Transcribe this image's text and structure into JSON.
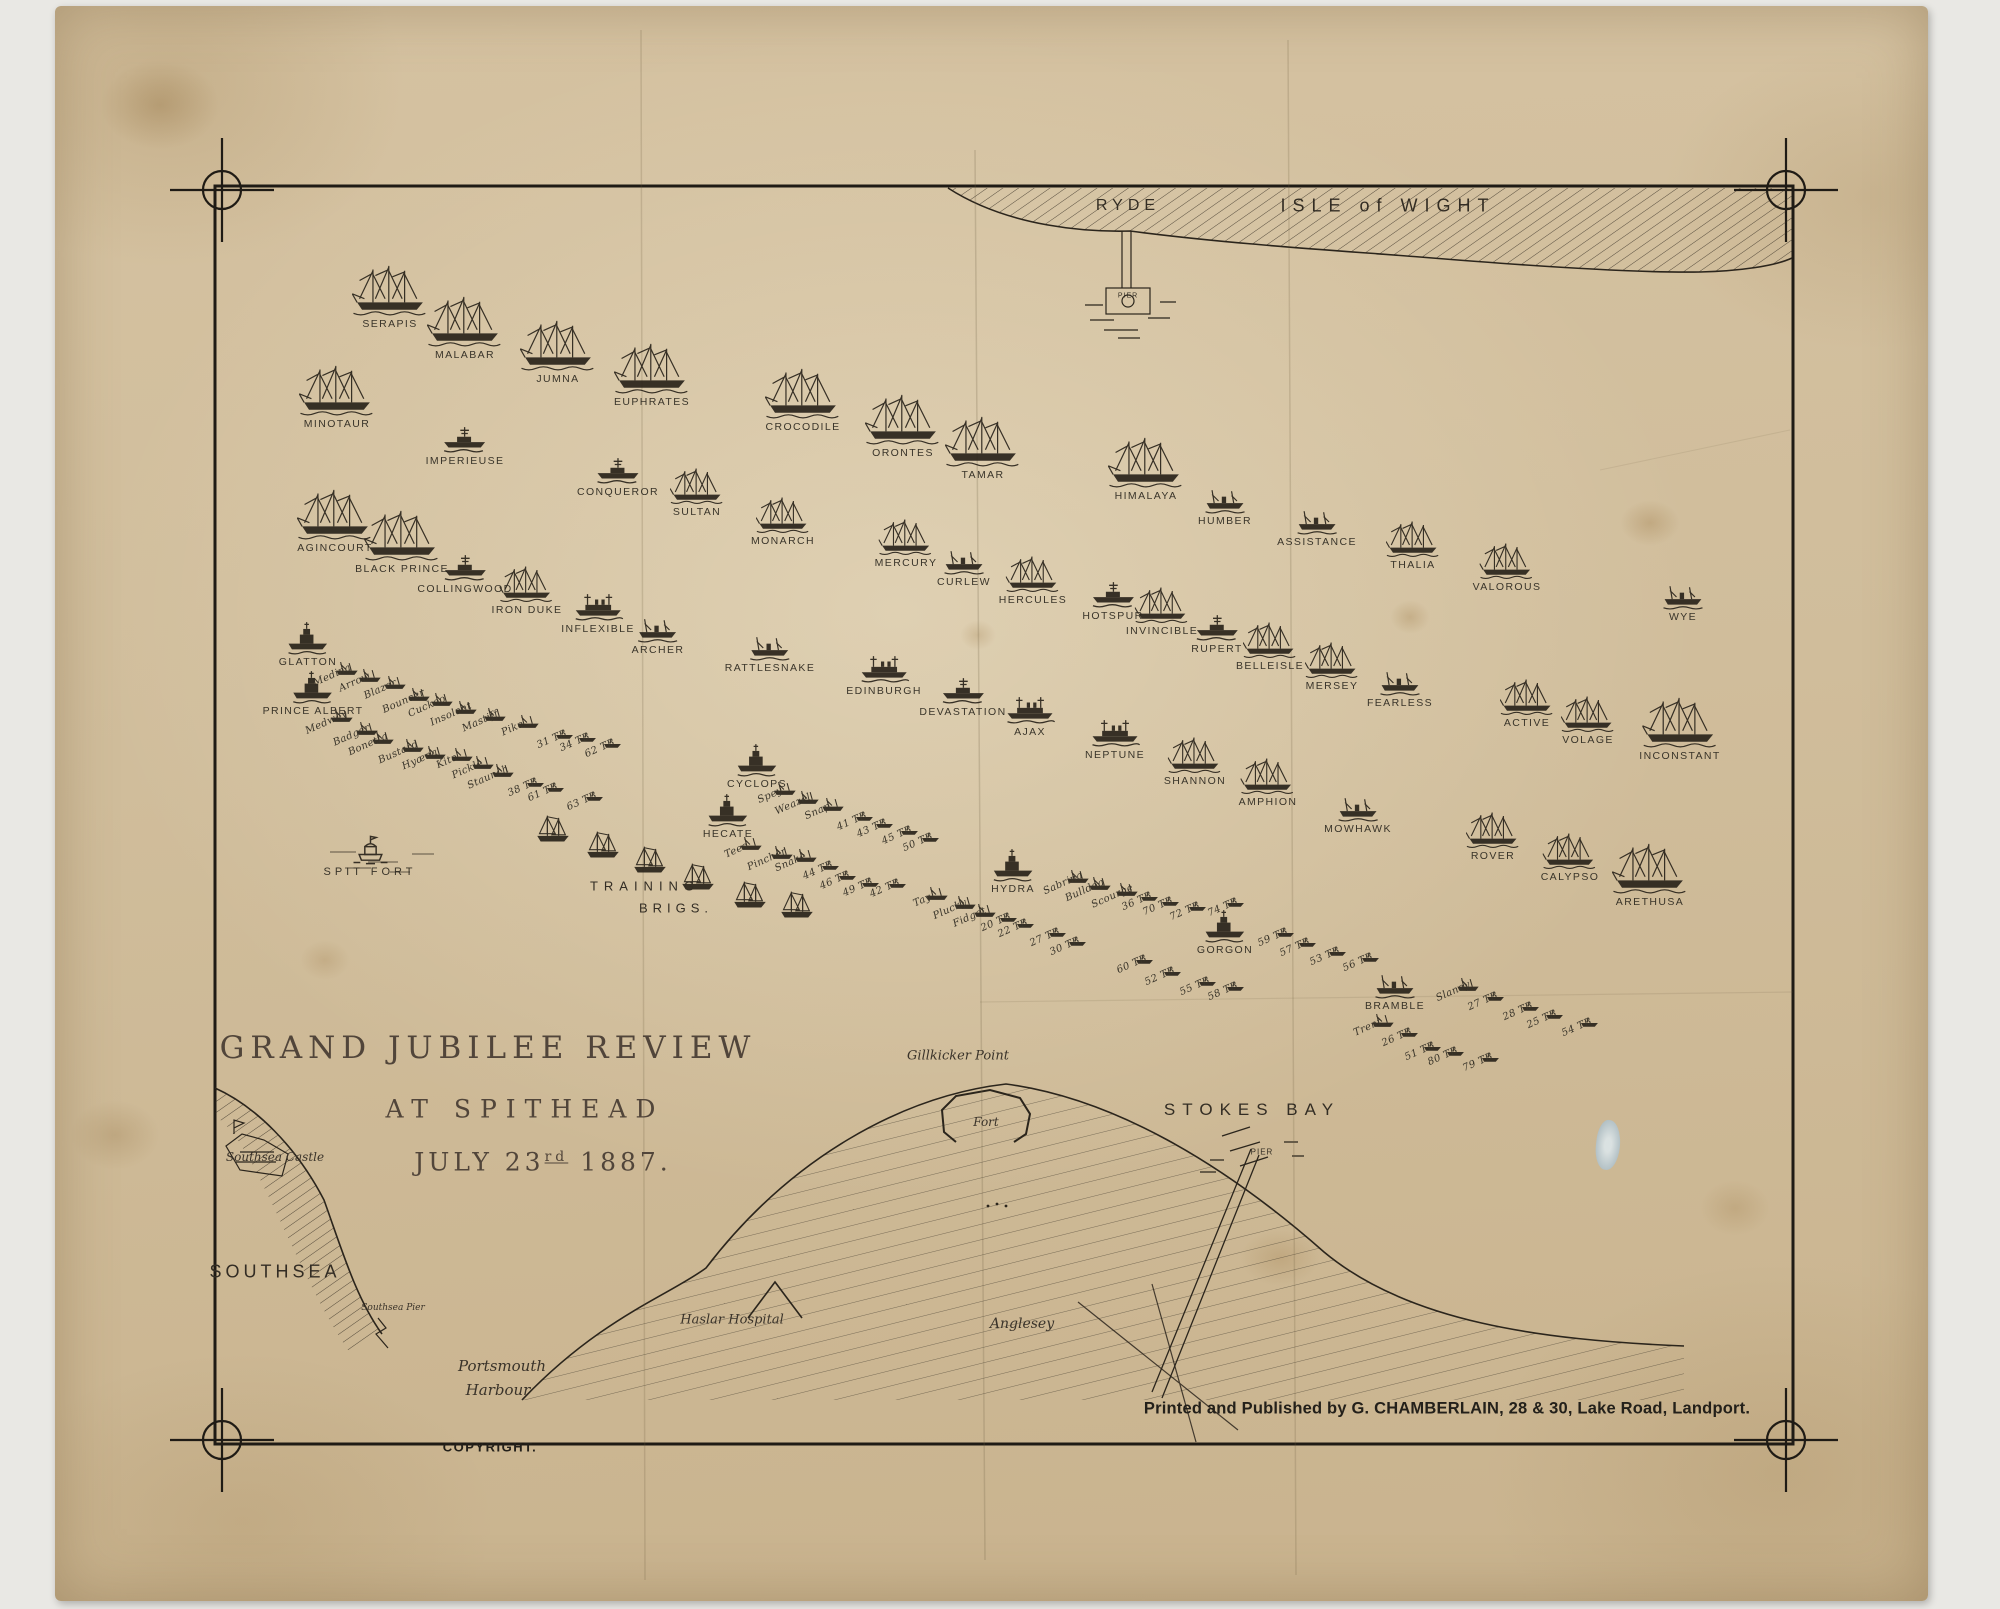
{
  "title": {
    "line1": "GRAND JUBILEE REVIEW",
    "line2": "AT SPITHEAD",
    "date_pre": "JULY 23",
    "date_sup": "rd",
    "date_post": " 1887."
  },
  "imprint": {
    "publisher": "Printed and Published by G. CHAMBERLAIN, 28 & 30, Lake Road, Landport.",
    "copyright": "COPYRIGHT."
  },
  "geography": {
    "isle_of_wight": "ISLE of WIGHT",
    "ryde": "RYDE",
    "ryde_pier": "PIER",
    "training_1": "TRAINING",
    "training_2": "BRIGS.",
    "southsea_castle": "Southsea Castle",
    "southsea": "SOUTHSEA",
    "southsea_pier": "Southsea Pier",
    "portsmouth_1": "Portsmouth",
    "portsmouth_2": "Harbour",
    "gillkicker": "Gillkicker Point",
    "fort": "Fort",
    "haslar": "Haslar Hospital",
    "anglesey": "Anglesey",
    "stokes_bay": "STOKES BAY",
    "stokes_pier": "PIER"
  },
  "colors": {
    "paper": "#d2bf9e",
    "ink": "#2b251c",
    "scan_bed": "#e9e8e4"
  },
  "ships": [
    {
      "n": "SERAPIS",
      "x": 390,
      "y": 330,
      "t": "sailL"
    },
    {
      "n": "MALABAR",
      "x": 465,
      "y": 361,
      "t": "sailL"
    },
    {
      "n": "JUMNA",
      "x": 558,
      "y": 385,
      "t": "sailL"
    },
    {
      "n": "EUPHRATES",
      "x": 652,
      "y": 408,
      "t": "sailL"
    },
    {
      "n": "CROCODILE",
      "x": 803,
      "y": 433,
      "t": "sailL"
    },
    {
      "n": "ORONTES",
      "x": 903,
      "y": 459,
      "t": "sailL"
    },
    {
      "n": "TAMAR",
      "x": 983,
      "y": 481,
      "t": "sailL"
    },
    {
      "n": "HIMALAYA",
      "x": 1146,
      "y": 502,
      "t": "sailL"
    },
    {
      "n": "HUMBER",
      "x": 1225,
      "y": 527,
      "t": "steamer"
    },
    {
      "n": "ASSISTANCE",
      "x": 1317,
      "y": 548,
      "t": "steamer"
    },
    {
      "n": "THALIA",
      "x": 1413,
      "y": 571,
      "t": "sailM"
    },
    {
      "n": "VALOROUS",
      "x": 1507,
      "y": 593,
      "t": "sailM"
    },
    {
      "n": "WYE",
      "x": 1683,
      "y": 623,
      "t": "steamer"
    },
    {
      "n": "MINOTAUR",
      "x": 337,
      "y": 430,
      "t": "sailL"
    },
    {
      "n": "IMPERIEUSE",
      "x": 465,
      "y": 467,
      "t": "bb"
    },
    {
      "n": "CONQUEROR",
      "x": 618,
      "y": 498,
      "t": "bb"
    },
    {
      "n": "SULTAN",
      "x": 697,
      "y": 518,
      "t": "sailM"
    },
    {
      "n": "MONARCH",
      "x": 783,
      "y": 547,
      "t": "sailM"
    },
    {
      "n": "MERCURY",
      "x": 906,
      "y": 569,
      "t": "sailM"
    },
    {
      "n": "CURLEW",
      "x": 964,
      "y": 588,
      "t": "steamer"
    },
    {
      "n": "HERCULES",
      "x": 1033,
      "y": 606,
      "t": "sailM"
    },
    {
      "n": "HOTSPUR",
      "x": 1113,
      "y": 622,
      "t": "bb"
    },
    {
      "n": "INVINCIBLE",
      "x": 1162,
      "y": 637,
      "t": "sailM"
    },
    {
      "n": "RUPERT",
      "x": 1217,
      "y": 655,
      "t": "bb"
    },
    {
      "n": "BELLEISLE",
      "x": 1270,
      "y": 672,
      "t": "sailM"
    },
    {
      "n": "MERSEY",
      "x": 1332,
      "y": 692,
      "t": "sailM"
    },
    {
      "n": "FEARLESS",
      "x": 1400,
      "y": 709,
      "t": "steamer"
    },
    {
      "n": "ACTIVE",
      "x": 1527,
      "y": 729,
      "t": "sailM"
    },
    {
      "n": "VOLAGE",
      "x": 1588,
      "y": 746,
      "t": "sailM"
    },
    {
      "n": "INCONSTANT",
      "x": 1680,
      "y": 762,
      "t": "sailL"
    },
    {
      "n": "AGINCOURT",
      "x": 335,
      "y": 554,
      "t": "sailL"
    },
    {
      "n": "BLACK PRINCE",
      "x": 402,
      "y": 575,
      "t": "sailL"
    },
    {
      "n": "COLLINGWOOD",
      "x": 465,
      "y": 595,
      "t": "bb"
    },
    {
      "n": "IRON DUKE",
      "x": 527,
      "y": 616,
      "t": "sailM"
    },
    {
      "n": "INFLEXIBLE",
      "x": 598,
      "y": 635,
      "t": "bb2"
    },
    {
      "n": "ARCHER",
      "x": 658,
      "y": 656,
      "t": "steamer"
    },
    {
      "n": "RATTLESNAKE",
      "x": 770,
      "y": 674,
      "t": "steamer"
    },
    {
      "n": "EDINBURGH",
      "x": 884,
      "y": 697,
      "t": "bb2"
    },
    {
      "n": "DEVASTATION",
      "x": 963,
      "y": 718,
      "t": "bb"
    },
    {
      "n": "AJAX",
      "x": 1030,
      "y": 738,
      "t": "bb2"
    },
    {
      "n": "NEPTUNE",
      "x": 1115,
      "y": 761,
      "t": "bb2"
    },
    {
      "n": "SHANNON",
      "x": 1195,
      "y": 787,
      "t": "sailM"
    },
    {
      "n": "AMPHION",
      "x": 1268,
      "y": 808,
      "t": "sailM"
    },
    {
      "n": "MOWHAWK",
      "x": 1358,
      "y": 835,
      "t": "steamer"
    },
    {
      "n": "ROVER",
      "x": 1493,
      "y": 862,
      "t": "sailM"
    },
    {
      "n": "CALYPSO",
      "x": 1570,
      "y": 883,
      "t": "sailM"
    },
    {
      "n": "ARETHUSA",
      "x": 1650,
      "y": 908,
      "t": "sailL"
    },
    {
      "n": "GLATTON",
      "x": 308,
      "y": 668,
      "t": "mon"
    },
    {
      "n": "PRINCE ALBERT",
      "x": 313,
      "y": 717,
      "t": "mon"
    },
    {
      "n": "CYCLOPS",
      "x": 757,
      "y": 790,
      "t": "mon"
    },
    {
      "n": "HECATE",
      "x": 728,
      "y": 840,
      "t": "mon"
    },
    {
      "n": "HYDRA",
      "x": 1013,
      "y": 895,
      "t": "mon"
    },
    {
      "n": "GORGON",
      "x": 1225,
      "y": 956,
      "t": "mon"
    },
    {
      "n": "BRAMBLE",
      "x": 1395,
      "y": 1012,
      "t": "steamer"
    },
    {
      "n": "SPIT FORT",
      "x": 370,
      "y": 878,
      "t": "fort",
      "s": "wide"
    },
    {
      "n": "Medina",
      "x": 332,
      "y": 681,
      "t": "gb",
      "s": "script"
    },
    {
      "n": "Arrow",
      "x": 355,
      "y": 688,
      "t": "gb",
      "s": "script"
    },
    {
      "n": "Blazer",
      "x": 380,
      "y": 695,
      "t": "gb",
      "s": "script"
    },
    {
      "n": "Bouncer",
      "x": 404,
      "y": 707,
      "t": "gb",
      "s": "script"
    },
    {
      "n": "Cuckoo",
      "x": 427,
      "y": 712,
      "t": "gb",
      "s": "script"
    },
    {
      "n": "Insolent",
      "x": 451,
      "y": 720,
      "t": "gb",
      "s": "script"
    },
    {
      "n": "Mastiff",
      "x": 480,
      "y": 727,
      "t": "gb",
      "s": "script"
    },
    {
      "n": "Pike",
      "x": 513,
      "y": 734,
      "t": "gb",
      "s": "script"
    },
    {
      "n": "Medway",
      "x": 327,
      "y": 728,
      "t": "gb",
      "s": "script"
    },
    {
      "n": "Badger",
      "x": 352,
      "y": 741,
      "t": "gb",
      "s": "script"
    },
    {
      "n": "Bonetta",
      "x": 368,
      "y": 750,
      "t": "gb",
      "s": "script"
    },
    {
      "n": "Bustard",
      "x": 398,
      "y": 758,
      "t": "gb",
      "s": "script"
    },
    {
      "n": "Hyæna",
      "x": 420,
      "y": 765,
      "t": "gb",
      "s": "script"
    },
    {
      "n": "Kite",
      "x": 447,
      "y": 767,
      "t": "gb",
      "s": "script"
    },
    {
      "n": "Pickle",
      "x": 468,
      "y": 775,
      "t": "gb",
      "s": "script"
    },
    {
      "n": "Staunch",
      "x": 488,
      "y": 783,
      "t": "gb",
      "s": "script"
    },
    {
      "n": "Spey",
      "x": 770,
      "y": 801,
      "t": "gb",
      "s": "script"
    },
    {
      "n": "Weazel",
      "x": 793,
      "y": 810,
      "t": "gb",
      "s": "script"
    },
    {
      "n": "Snap",
      "x": 818,
      "y": 817,
      "t": "gb",
      "s": "script"
    },
    {
      "n": "Tees",
      "x": 736,
      "y": 856,
      "t": "gb",
      "s": "script"
    },
    {
      "n": "Pincher",
      "x": 767,
      "y": 865,
      "t": "gb",
      "s": "script"
    },
    {
      "n": "Snake",
      "x": 791,
      "y": 868,
      "t": "gb",
      "s": "script"
    },
    {
      "n": "Tay",
      "x": 922,
      "y": 906,
      "t": "gb",
      "s": "script"
    },
    {
      "n": "Plucky",
      "x": 950,
      "y": 915,
      "t": "gb",
      "s": "script"
    },
    {
      "n": "Fidget",
      "x": 970,
      "y": 923,
      "t": "gb",
      "s": "script"
    },
    {
      "n": "Sabrina",
      "x": 1063,
      "y": 889,
      "t": "gb",
      "s": "script"
    },
    {
      "n": "Bulldog",
      "x": 1085,
      "y": 896,
      "t": "gb",
      "s": "script"
    },
    {
      "n": "Scourge",
      "x": 1112,
      "y": 902,
      "t": "gb",
      "s": "script"
    },
    {
      "n": "Trent",
      "x": 1368,
      "y": 1033,
      "t": "gb",
      "s": "script"
    },
    {
      "n": "Slaney",
      "x": 1453,
      "y": 997,
      "t": "gb",
      "s": "script"
    },
    {
      "n": "31 TB",
      "x": 552,
      "y": 745,
      "t": "tb",
      "s": "tb"
    },
    {
      "n": "34 TB",
      "x": 575,
      "y": 748,
      "t": "tb",
      "s": "tb"
    },
    {
      "n": "62 TB",
      "x": 600,
      "y": 754,
      "t": "tb",
      "s": "tb"
    },
    {
      "n": "38 TB",
      "x": 523,
      "y": 793,
      "t": "tb",
      "s": "tb"
    },
    {
      "n": "61 TB",
      "x": 543,
      "y": 798,
      "t": "tb",
      "s": "tb"
    },
    {
      "n": "63 TB",
      "x": 582,
      "y": 807,
      "t": "tb",
      "s": "tb"
    },
    {
      "n": "41 TB",
      "x": 852,
      "y": 827,
      "t": "tb",
      "s": "tb"
    },
    {
      "n": "43 TB",
      "x": 872,
      "y": 834,
      "t": "tb",
      "s": "tb"
    },
    {
      "n": "45 TB",
      "x": 897,
      "y": 841,
      "t": "tb",
      "s": "tb"
    },
    {
      "n": "50 TB",
      "x": 918,
      "y": 848,
      "t": "tb",
      "s": "tb"
    },
    {
      "n": "44 TB",
      "x": 818,
      "y": 876,
      "t": "tb",
      "s": "tb"
    },
    {
      "n": "46 TB",
      "x": 835,
      "y": 886,
      "t": "tb",
      "s": "tb"
    },
    {
      "n": "49 TB",
      "x": 858,
      "y": 893,
      "t": "tb",
      "s": "tb"
    },
    {
      "n": "42 TB",
      "x": 885,
      "y": 894,
      "t": "tb",
      "s": "tb"
    },
    {
      "n": "20 TB",
      "x": 996,
      "y": 928,
      "t": "tb",
      "s": "tb"
    },
    {
      "n": "22 TB",
      "x": 1013,
      "y": 934,
      "t": "tb",
      "s": "tb"
    },
    {
      "n": "27 TB",
      "x": 1045,
      "y": 943,
      "t": "tb",
      "s": "tb"
    },
    {
      "n": "30 TB",
      "x": 1065,
      "y": 952,
      "t": "tb",
      "s": "tb"
    },
    {
      "n": "36 TB",
      "x": 1137,
      "y": 907,
      "t": "tb",
      "s": "tb"
    },
    {
      "n": "70 TB",
      "x": 1158,
      "y": 912,
      "t": "tb",
      "s": "tb"
    },
    {
      "n": "72 TB",
      "x": 1185,
      "y": 917,
      "t": "tb",
      "s": "tb"
    },
    {
      "n": "74 TB",
      "x": 1223,
      "y": 913,
      "t": "tb",
      "s": "tb"
    },
    {
      "n": "60 TB",
      "x": 1132,
      "y": 970,
      "t": "tb",
      "s": "tb"
    },
    {
      "n": "52 TB",
      "x": 1160,
      "y": 982,
      "t": "tb",
      "s": "tb"
    },
    {
      "n": "55 TB",
      "x": 1195,
      "y": 992,
      "t": "tb",
      "s": "tb"
    },
    {
      "n": "58 TB",
      "x": 1223,
      "y": 997,
      "t": "tb",
      "s": "tb"
    },
    {
      "n": "59 TB",
      "x": 1273,
      "y": 943,
      "t": "tb",
      "s": "tb"
    },
    {
      "n": "57 TB",
      "x": 1295,
      "y": 953,
      "t": "tb",
      "s": "tb"
    },
    {
      "n": "53 TB",
      "x": 1325,
      "y": 962,
      "t": "tb",
      "s": "tb"
    },
    {
      "n": "56 TB",
      "x": 1358,
      "y": 968,
      "t": "tb",
      "s": "tb"
    },
    {
      "n": "27 TB",
      "x": 1483,
      "y": 1007,
      "t": "tb",
      "s": "tb"
    },
    {
      "n": "28 TB",
      "x": 1518,
      "y": 1017,
      "t": "tb",
      "s": "tb"
    },
    {
      "n": "25 TB",
      "x": 1542,
      "y": 1025,
      "t": "tb",
      "s": "tb"
    },
    {
      "n": "54 TB",
      "x": 1577,
      "y": 1033,
      "t": "tb",
      "s": "tb"
    },
    {
      "n": "26 TB",
      "x": 1397,
      "y": 1043,
      "t": "tb",
      "s": "tb"
    },
    {
      "n": "51 TB",
      "x": 1420,
      "y": 1057,
      "t": "tb",
      "s": "tb"
    },
    {
      "n": "80 TB",
      "x": 1443,
      "y": 1062,
      "t": "tb",
      "s": "tb"
    },
    {
      "n": "79 TB",
      "x": 1478,
      "y": 1068,
      "t": "tb",
      "s": "tb"
    },
    {
      "n": "",
      "x": 553,
      "y": 845,
      "t": "brig"
    },
    {
      "n": "",
      "x": 603,
      "y": 861,
      "t": "brig"
    },
    {
      "n": "",
      "x": 650,
      "y": 876,
      "t": "brig"
    },
    {
      "n": "",
      "x": 698,
      "y": 893,
      "t": "brig"
    },
    {
      "n": "",
      "x": 750,
      "y": 911,
      "t": "brig"
    },
    {
      "n": "",
      "x": 797,
      "y": 921,
      "t": "brig"
    }
  ]
}
